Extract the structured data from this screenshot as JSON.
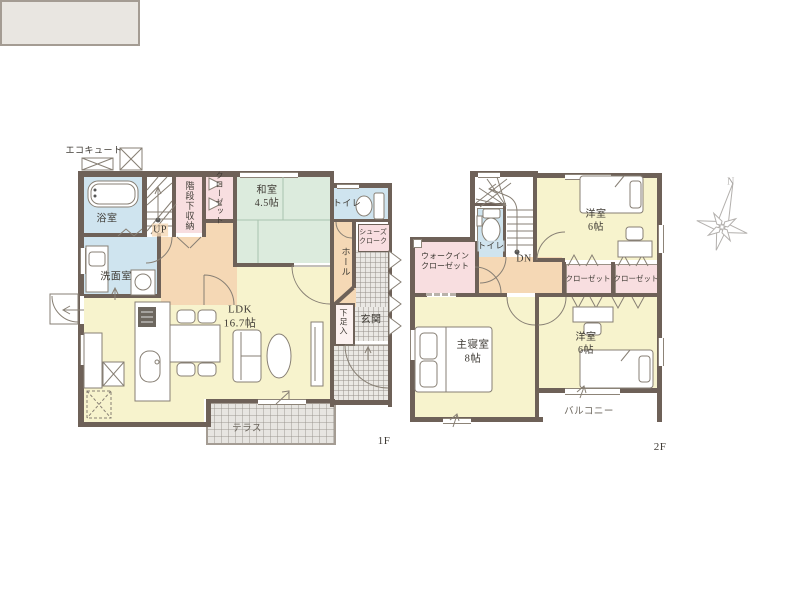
{
  "colors": {
    "wall": "#6e6158",
    "room_yellow": "#f7f3cd",
    "room_green": "#dcebdd",
    "room_pink": "#f8dee0",
    "room_blue": "#cfe4ef",
    "hall_orange": "#f5d8b5",
    "tile_gray": "#eae8e4",
    "text": "#3f3b35",
    "compass_gray": "#b3b0ad"
  },
  "floor1": {
    "floor_label": "1F",
    "ecocute": "エコキュート",
    "bath": "浴室",
    "washroom": "洗面室",
    "stairs_up": "UP",
    "under_stair_storage": "階段下収納",
    "closet": "クローゼット",
    "japanese_room_name": "和室",
    "japanese_room_size": "4.5帖",
    "toilet": "トイレ",
    "shoes_cloak_line1": "シューズ",
    "shoes_cloak_line2": "クローク",
    "hall": "ホール",
    "shoe_cabinet": "下足入",
    "entrance": "玄関",
    "ldk_name": "LDK",
    "ldk_size": "16.7帖",
    "terrace": "テラス"
  },
  "floor2": {
    "floor_label": "2F",
    "walk_in_closet_line1": "ウォークイン",
    "walk_in_closet_line2": "クローゼット",
    "toilet": "トイレ",
    "stairs_down": "DN",
    "bedroom_top_name": "洋室",
    "bedroom_top_size": "6帖",
    "closet_left": "クローゼット",
    "closet_right": "クローゼット",
    "master_bedroom_name": "主寝室",
    "master_bedroom_size": "8帖",
    "bedroom_bottom_name": "洋室",
    "bedroom_bottom_size": "6帖",
    "balcony": "バルコニー"
  },
  "compass": {
    "north_label": "N"
  }
}
